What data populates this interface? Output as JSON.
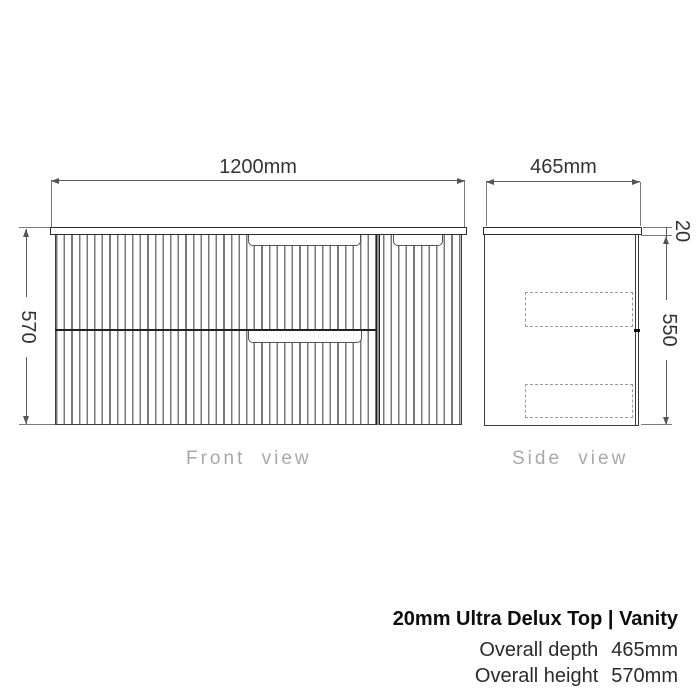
{
  "front_view": {
    "width_label": "1200mm",
    "height_label": "570",
    "caption": "Front view"
  },
  "side_view": {
    "depth_label": "465mm",
    "top_thickness_label": "20",
    "cabinet_height_label": "550",
    "caption": "Side view"
  },
  "footer": {
    "title": "20mm Ultra Delux Top | Vanity",
    "specs": [
      {
        "label": "Overall depth",
        "value": "465mm"
      },
      {
        "label": "Overall height",
        "value": "570mm"
      }
    ]
  },
  "colors": {
    "background": "#ffffff",
    "drawing_line": "#3a3a3a",
    "dimension_line": "#5a5a5a",
    "flute_line": "#787878",
    "hidden_line": "#9a9a9a",
    "caption_text": "#a8a8a8",
    "footer_text": "#0d0d0d"
  }
}
